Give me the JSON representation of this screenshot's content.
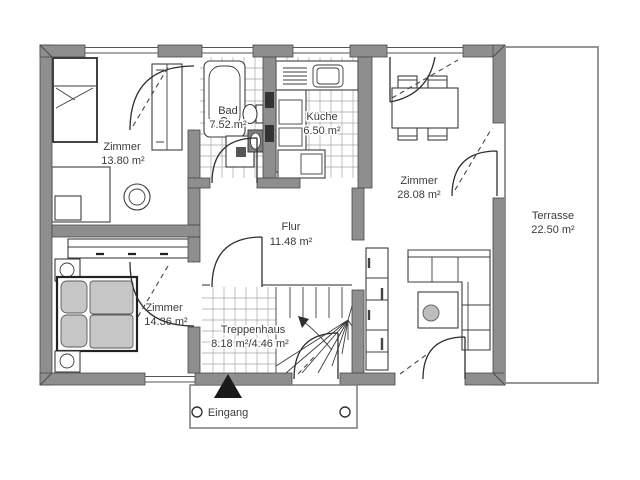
{
  "rooms": {
    "zimmer1": {
      "name": "Zimmer",
      "area": "13.80 m²"
    },
    "bad": {
      "name": "Bad",
      "area": "7.52 m²"
    },
    "kueche": {
      "name": "Küche",
      "area": "6.50 m²"
    },
    "zimmer2": {
      "name": "Zimmer",
      "area": "28.08 m²"
    },
    "flur": {
      "name": "Flur",
      "area": "11.48 m²"
    },
    "zimmer3": {
      "name": "Zimmer",
      "area": "14.36 m²"
    },
    "treppenhaus": {
      "name": "Treppenhaus",
      "area": "8.18 m²/4.46 m²"
    },
    "terrasse": {
      "name": "Terrasse",
      "area": "22.50 m²"
    }
  },
  "entrance": {
    "label": "Eingang"
  },
  "colors": {
    "wall": "#8e8e8e",
    "outline": "#4a4a4a",
    "tile_line": "#a8a8a8",
    "furniture_fill": "#c6c6c6",
    "text": "#3b3b3b",
    "entrance_marker": "#1a1a1a"
  }
}
